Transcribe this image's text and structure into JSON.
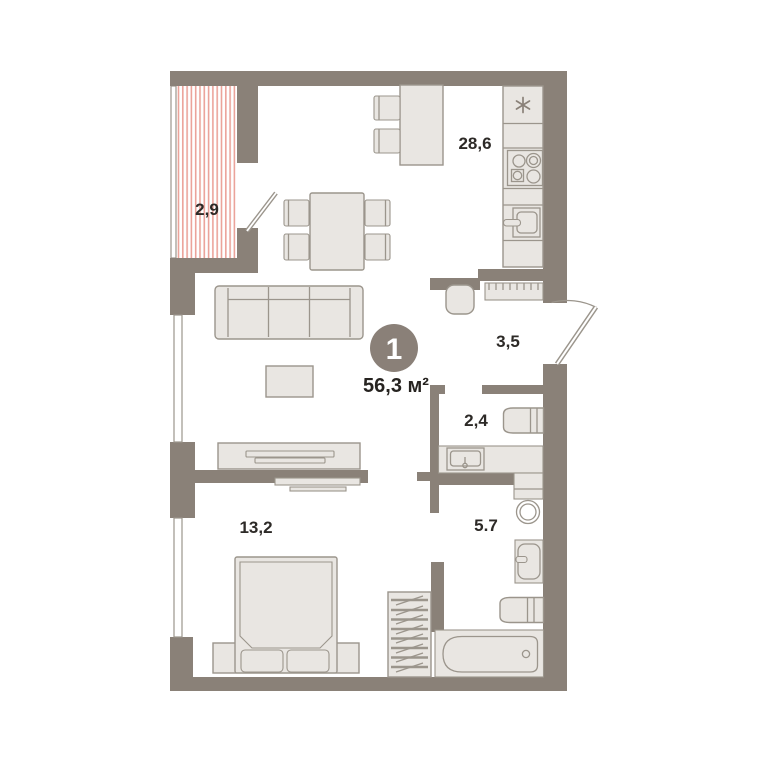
{
  "plan": {
    "type": "apartment-floor-plan",
    "badge": {
      "rooms_count": "1",
      "total_area": "56,3 м²"
    },
    "rooms": [
      {
        "name": "balcony",
        "area": "2,9"
      },
      {
        "name": "kitchen-living-room",
        "area": "28,6"
      },
      {
        "name": "hallway",
        "area": "3,5"
      },
      {
        "name": "bathroom-small",
        "area": "2,4"
      },
      {
        "name": "bathroom-large",
        "area": "5.7"
      },
      {
        "name": "bedroom",
        "area": "13,2"
      }
    ],
    "icons": {
      "fridge": "snowflake-icon"
    },
    "colors": {
      "wall": "#8a8178",
      "furniture_fill": "#e9e6e2",
      "furniture_stroke": "#9b958c",
      "balcony_hatch": "#eba39a",
      "label_text": "#2d2a27",
      "badge_fill": "#8a8078",
      "badge_text": "#ffffff",
      "background": "#ffffff"
    }
  }
}
